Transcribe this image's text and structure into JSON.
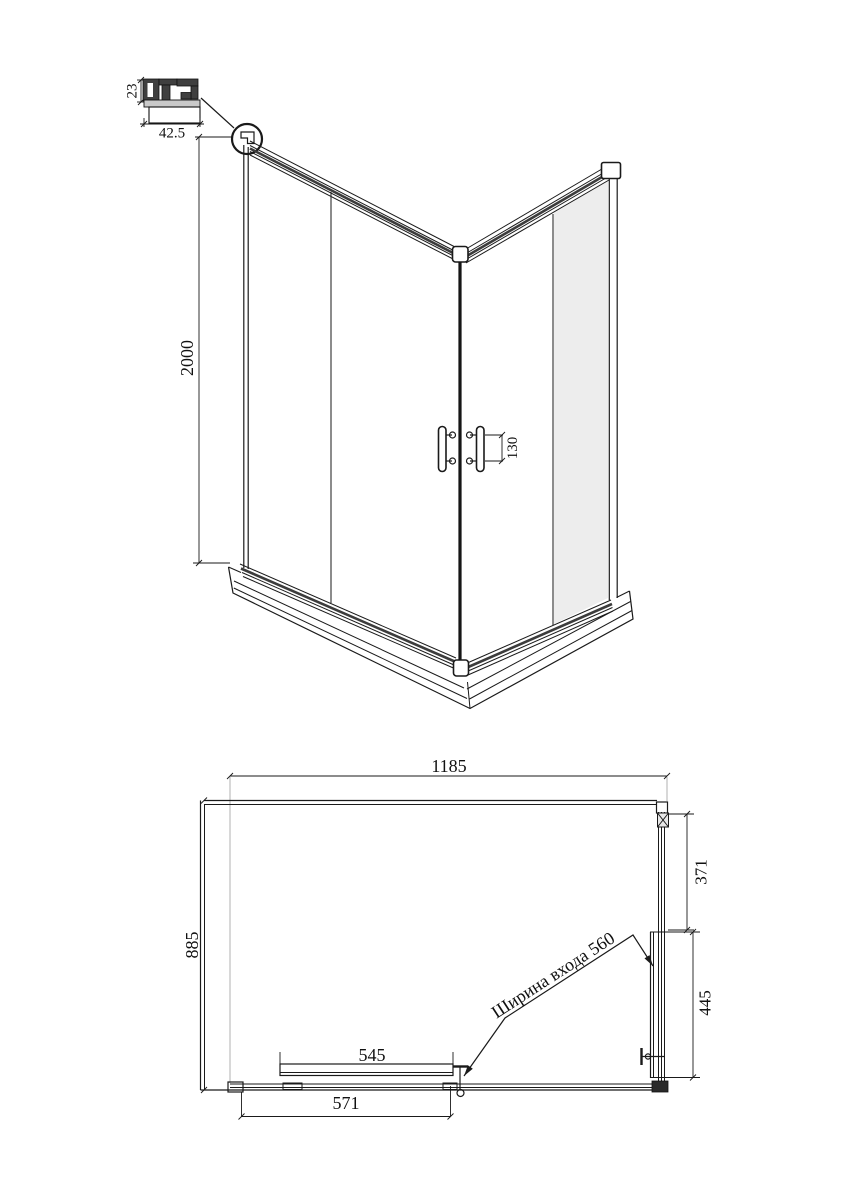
{
  "drawing": {
    "background_color": "#ffffff",
    "line_color": "#1a1a1a",
    "glass_tint_color": "#ededed",
    "profile_detail": {
      "height_label": "23",
      "width_label": "42.5"
    },
    "perspective_view": {
      "height_label": "2000",
      "handle_pitch_label": "130"
    },
    "plan_view": {
      "overall_width_label": "1185",
      "overall_depth_label": "885",
      "side_fixed_panel_label": "371",
      "side_door_label": "445",
      "front_door_label": "545",
      "front_panel_label": "571",
      "entry_width_label": "Ширина входа 560"
    }
  }
}
